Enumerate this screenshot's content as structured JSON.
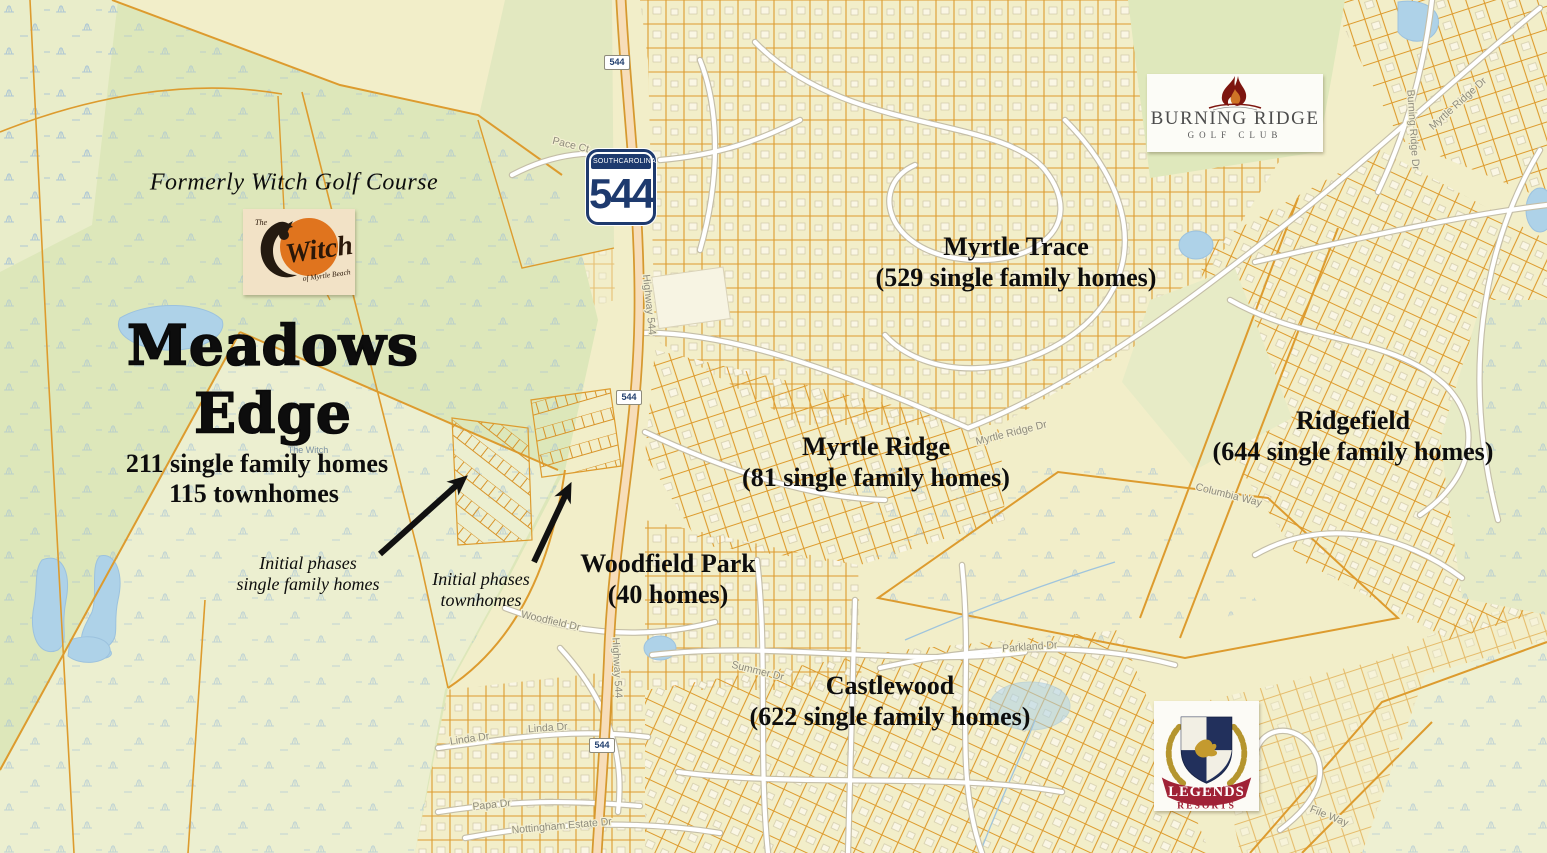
{
  "annotations": {
    "formerly": "Formerly Witch Golf Course",
    "meadows_edge": {
      "name_line1": "Meadows",
      "name_line2": "Edge",
      "stat_line1": "211 single family homes",
      "stat_line2": "115 townhomes"
    },
    "initial_phases_sf": {
      "line1": "Initial phases",
      "line2": "single family homes"
    },
    "initial_phases_th": {
      "line1": "Initial phases",
      "line2": "townhomes"
    }
  },
  "communities": [
    {
      "name": "Myrtle Trace",
      "detail": "(529 single family homes)"
    },
    {
      "name": "Myrtle Ridge",
      "detail": "(81 single family homes)"
    },
    {
      "name": "Ridgefield",
      "detail": "(644 single family homes)"
    },
    {
      "name": "Woodfield Park",
      "detail": "(40 homes)"
    },
    {
      "name": "Castlewood",
      "detail": "(622 single family homes)"
    }
  ],
  "logos": {
    "witch": {
      "prefix": "The",
      "name": "Witch",
      "sub": "of Myrtle Beach"
    },
    "burning_ridge": {
      "name": "BURNING RIDGE",
      "sub": "GOLF CLUB"
    },
    "legends": {
      "name": "LEGENDS",
      "sub": "RESORTS"
    }
  },
  "highway_shield": {
    "state_left": "SOUTH",
    "state_right": "CAROLINA",
    "number": "544"
  },
  "road_markers": {
    "marker_544": "544"
  },
  "street_labels": {
    "highway_544_upper": "Highway 544",
    "highway_544_lower": "Highway 544",
    "myrtle_ridge_dr_mid": "Myrtle Ridge Dr",
    "myrtle_ridge_dr_ne": "Myrtle Ridge Dr",
    "burning_ridge_dr": "Burning Ridge Dr",
    "pace_ct": "Pace Ct",
    "linda_dr_w": "Linda Dr",
    "linda_dr_e": "Linda Dr",
    "papa_dr": "Papa Dr",
    "nottingham_estate_dr": "Nottingham Estate Dr",
    "summer_dr": "Summer Dr",
    "woodfield_dr": "Woodfield Dr",
    "parkland_dr": "Parkland Dr",
    "columbia_way": "Columbia Way",
    "file_way": "File Way",
    "the_witch": "The Witch"
  },
  "colors": {
    "base": "#f2eec9",
    "green": "#dde7ba",
    "green_light": "#ebeecd",
    "parcel_orange": "#dd9b2e",
    "water": "#aed2e8",
    "highway_fill": "#f7ddb9",
    "road_casing": "#c4bea8",
    "shield_navy": "#1e3a6e",
    "flame_red": "#7d150f",
    "legends_red": "#a02236",
    "arrow_black": "#111111"
  }
}
